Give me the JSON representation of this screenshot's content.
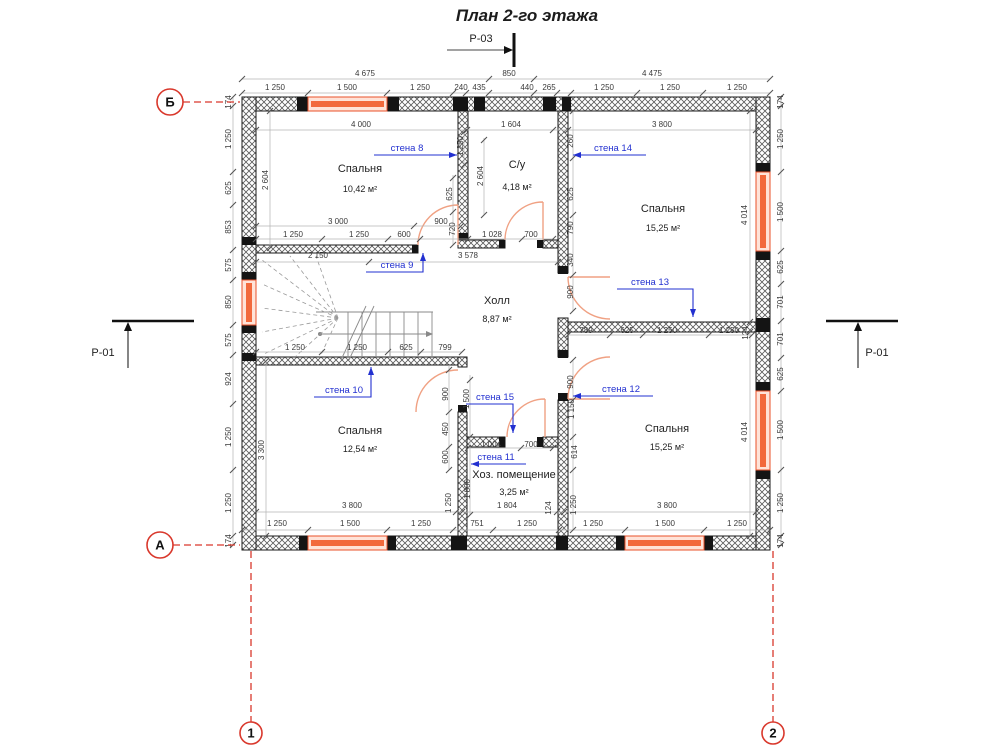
{
  "title": "План 2-го этажа",
  "sections": {
    "top": "Р-03",
    "left": "Р-01",
    "right": "Р-01"
  },
  "colors": {
    "accent_red": "#d9382c",
    "window_orange": "#f2693c",
    "label_blue": "#2230d0"
  },
  "rooms": [
    {
      "name": "Спальня",
      "area": "10,42 м²",
      "x": 360,
      "y": 172,
      "ay": 192
    },
    {
      "name": "С/у",
      "area": "4,18 м²",
      "x": 517,
      "y": 168,
      "ay": 190
    },
    {
      "name": "Спальня",
      "area": "15,25 м²",
      "x": 663,
      "y": 212,
      "ay": 231
    },
    {
      "name": "Холл",
      "area": "8,87 м²",
      "x": 497,
      "y": 304,
      "ay": 322
    },
    {
      "name": "Спальня",
      "area": "12,54 м²",
      "x": 360,
      "y": 434,
      "ay": 452
    },
    {
      "name": "Хоз. помещение",
      "area": "3,25 м²",
      "x": 514,
      "y": 478,
      "ay": 495
    },
    {
      "name": "Спальня",
      "area": "15,25 м²",
      "x": 667,
      "y": 432,
      "ay": 450
    }
  ],
  "wall_labels": [
    {
      "t": "стена 8",
      "x": 407,
      "y": 151,
      "line": [
        [
          374,
          155
        ],
        [
          457,
          155
        ]
      ],
      "head": "right"
    },
    {
      "t": "стена 14",
      "x": 613,
      "y": 151,
      "line": [
        [
          646,
          155
        ],
        [
          573,
          155
        ]
      ],
      "head": "left"
    },
    {
      "t": "стена 9",
      "x": 397,
      "y": 268,
      "line": [
        [
          366,
          272
        ],
        [
          423,
          272
        ],
        [
          423,
          253
        ]
      ],
      "head": "up"
    },
    {
      "t": "стена 13",
      "x": 650,
      "y": 285,
      "line": [
        [
          617,
          289
        ],
        [
          693,
          289
        ],
        [
          693,
          317
        ]
      ],
      "head": "down"
    },
    {
      "t": "стена 10",
      "x": 344,
      "y": 393,
      "line": [
        [
          314,
          397
        ],
        [
          371,
          397
        ],
        [
          371,
          367
        ]
      ],
      "head": "up"
    },
    {
      "t": "стена 15",
      "x": 495,
      "y": 400,
      "line": [
        [
          466,
          404
        ],
        [
          513,
          404
        ],
        [
          513,
          433
        ]
      ],
      "head": "down"
    },
    {
      "t": "стена 12",
      "x": 621,
      "y": 392,
      "line": [
        [
          653,
          396
        ],
        [
          573,
          396
        ]
      ],
      "head": "left"
    },
    {
      "t": "стена 11",
      "x": 496,
      "y": 460,
      "line": [
        [
          526,
          464
        ],
        [
          471,
          464
        ]
      ],
      "head": "left"
    }
  ],
  "grid_axes": [
    {
      "label": "Б",
      "cx": 170,
      "cy": 102,
      "r": 13,
      "dash": [
        [
          183,
          102
        ],
        [
          240,
          102
        ]
      ]
    },
    {
      "label": "А",
      "cx": 160,
      "cy": 545,
      "r": 13,
      "dash": [
        [
          173,
          545
        ],
        [
          240,
          545
        ]
      ]
    },
    {
      "label": "1",
      "cx": 251,
      "cy": 733,
      "r": 11,
      "dash": [
        [
          251,
          551
        ],
        [
          251,
          722
        ]
      ]
    },
    {
      "label": "2",
      "cx": 773,
      "cy": 733,
      "r": 11,
      "dash": [
        [
          773,
          551
        ],
        [
          773,
          722
        ]
      ]
    }
  ],
  "dims": [
    [
      "4 675",
      365,
      76,
      0
    ],
    [
      "850",
      509,
      76,
      0
    ],
    [
      "4 475",
      652,
      76,
      0
    ],
    [
      "1 250",
      275,
      90,
      0
    ],
    [
      "1 500",
      347,
      90,
      0
    ],
    [
      "1 250",
      420,
      90,
      0
    ],
    [
      "240",
      461,
      90,
      0
    ],
    [
      "435",
      479,
      90,
      0
    ],
    [
      "440",
      527,
      90,
      0
    ],
    [
      "265",
      549,
      90,
      0
    ],
    [
      "1 250",
      604,
      90,
      0
    ],
    [
      "1 250",
      670,
      90,
      0
    ],
    [
      "1 250",
      737,
      90,
      0
    ],
    [
      "4 000",
      361,
      127,
      0
    ],
    [
      "1 604",
      511,
      127,
      0
    ],
    [
      "3 800",
      662,
      127,
      0
    ],
    [
      "174",
      231,
      102,
      1
    ],
    [
      "1 250",
      231,
      139,
      1
    ],
    [
      "625",
      231,
      188,
      1
    ],
    [
      "853",
      231,
      227,
      1
    ],
    [
      "575",
      231,
      265,
      1
    ],
    [
      "850",
      231,
      302,
      1
    ],
    [
      "575",
      231,
      340,
      1
    ],
    [
      "924",
      231,
      379,
      1
    ],
    [
      "1 250",
      231,
      437,
      1
    ],
    [
      "1 250",
      231,
      503,
      1
    ],
    [
      "174",
      231,
      541,
      1
    ],
    [
      "174",
      783,
      102,
      1
    ],
    [
      "1 250",
      783,
      139,
      1
    ],
    [
      "1 500",
      783,
      212,
      1
    ],
    [
      "625",
      783,
      267,
      1
    ],
    [
      "701",
      783,
      302,
      1
    ],
    [
      "701",
      783,
      339,
      1
    ],
    [
      "625",
      783,
      374,
      1
    ],
    [
      "1 500",
      783,
      430,
      1
    ],
    [
      "1 250",
      783,
      503,
      1
    ],
    [
      "174",
      783,
      541,
      1
    ],
    [
      "2 604",
      268,
      180,
      1
    ],
    [
      "3 300",
      264,
      450,
      1
    ],
    [
      "4 014",
      747,
      215,
      1
    ],
    [
      "4 014",
      747,
      432,
      1
    ],
    [
      "3 000",
      338,
      224,
      0
    ],
    [
      "900",
      441,
      224,
      0
    ],
    [
      "1 250",
      293,
      237,
      0
    ],
    [
      "1 250",
      359,
      237,
      0
    ],
    [
      "600",
      404,
      237,
      0
    ],
    [
      "625",
      452,
      194,
      1
    ],
    [
      "720",
      455,
      229,
      1
    ],
    [
      "1 250",
      463,
      146,
      1
    ],
    [
      "1 028",
      492,
      237,
      0
    ],
    [
      "700",
      531,
      237,
      0
    ],
    [
      "2 604",
      483,
      176,
      1
    ],
    [
      "260",
      573,
      141,
      1
    ],
    [
      "625",
      573,
      194,
      1
    ],
    [
      "790",
      573,
      228,
      1
    ],
    [
      "340",
      573,
      260,
      1
    ],
    [
      "900",
      573,
      292,
      1
    ],
    [
      "2 150",
      318,
      258,
      0
    ],
    [
      "3 578",
      468,
      258,
      0
    ],
    [
      "1 250",
      295,
      350,
      0
    ],
    [
      "1 250",
      357,
      350,
      0
    ],
    [
      "625",
      406,
      350,
      0
    ],
    [
      "799",
      445,
      350,
      0
    ],
    [
      "789",
      586,
      333,
      0
    ],
    [
      "625",
      627,
      333,
      0
    ],
    [
      "1 250",
      667,
      333,
      0
    ],
    [
      "1 250",
      729,
      333,
      0
    ],
    [
      "124",
      748,
      333,
      1
    ],
    [
      "900",
      573,
      382,
      1
    ],
    [
      "900",
      448,
      394,
      1
    ],
    [
      "450",
      448,
      429,
      1
    ],
    [
      "600",
      448,
      457,
      1
    ],
    [
      "1 500",
      469,
      399,
      1
    ],
    [
      "1 800",
      470,
      489,
      1
    ],
    [
      "1 250",
      451,
      503,
      1
    ],
    [
      "1 004",
      491,
      447,
      0
    ],
    [
      "700",
      531,
      447,
      0
    ],
    [
      "1 150",
      574,
      409,
      1
    ],
    [
      "614",
      577,
      452,
      1
    ],
    [
      "1 250",
      576,
      505,
      1
    ],
    [
      "3 800",
      352,
      508,
      0
    ],
    [
      "1 804",
      507,
      508,
      0
    ],
    [
      "124",
      551,
      508,
      1
    ],
    [
      "3 800",
      667,
      508,
      0
    ],
    [
      "1 250",
      277,
      526,
      0
    ],
    [
      "1 500",
      350,
      526,
      0
    ],
    [
      "1 250",
      421,
      526,
      0
    ],
    [
      "751",
      477,
      526,
      0
    ],
    [
      "1 250",
      527,
      526,
      0
    ],
    [
      "1 250",
      593,
      526,
      0
    ],
    [
      "1 500",
      665,
      526,
      0
    ],
    [
      "1 250",
      737,
      526,
      0
    ]
  ]
}
